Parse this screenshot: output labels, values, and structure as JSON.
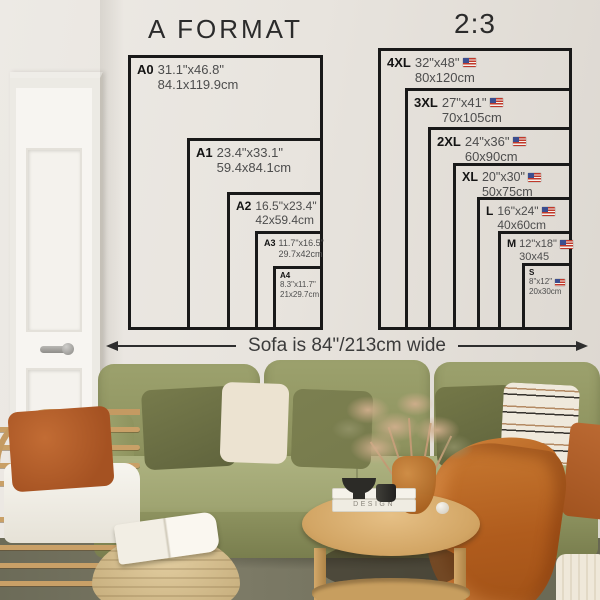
{
  "wall_guide": {
    "left_chart": {
      "title": "A FORMAT",
      "sizes": [
        {
          "code": "A0",
          "inches": "31.1\"x46.8\"",
          "cm": "84.1x119.9cm"
        },
        {
          "code": "A1",
          "inches": "23.4\"x33.1\"",
          "cm": "59.4x84.1cm"
        },
        {
          "code": "A2",
          "inches": "16.5\"x23.4\"",
          "cm": "42x59.4cm"
        },
        {
          "code": "A3",
          "inches": "11.7\"x16.5\"",
          "cm": "29.7x42cm"
        },
        {
          "code": "A4",
          "inches": "8.3\"x11.7\"",
          "cm": "21x29.7cm"
        }
      ]
    },
    "right_chart": {
      "title": "2:3",
      "flag_icon": "us-flag",
      "sizes": [
        {
          "code": "4XL",
          "inches": "32\"x48\"",
          "cm": "80x120cm"
        },
        {
          "code": "3XL",
          "inches": "27\"x41\"",
          "cm": "70x105cm"
        },
        {
          "code": "2XL",
          "inches": "24\"x36\"",
          "cm": "60x90cm"
        },
        {
          "code": "XL",
          "inches": "20\"x30\"",
          "cm": "50x75cm"
        },
        {
          "code": "L",
          "inches": "16\"x24\"",
          "cm": "40x60cm"
        },
        {
          "code": "M",
          "inches": "12\"x18\"",
          "cm": "30x45"
        },
        {
          "code": "S",
          "inches": "8\"x12\"",
          "cm": "20x30cm"
        }
      ]
    },
    "sofa_width_note": "Sofa is 84\"/213cm wide"
  },
  "scene": {
    "book_spine": "DESIGN"
  },
  "colors": {
    "frame_border": "#191919",
    "wall": "#e7e3dd",
    "sofa_olive": "#939862",
    "accent_rust": "#b5622c"
  }
}
